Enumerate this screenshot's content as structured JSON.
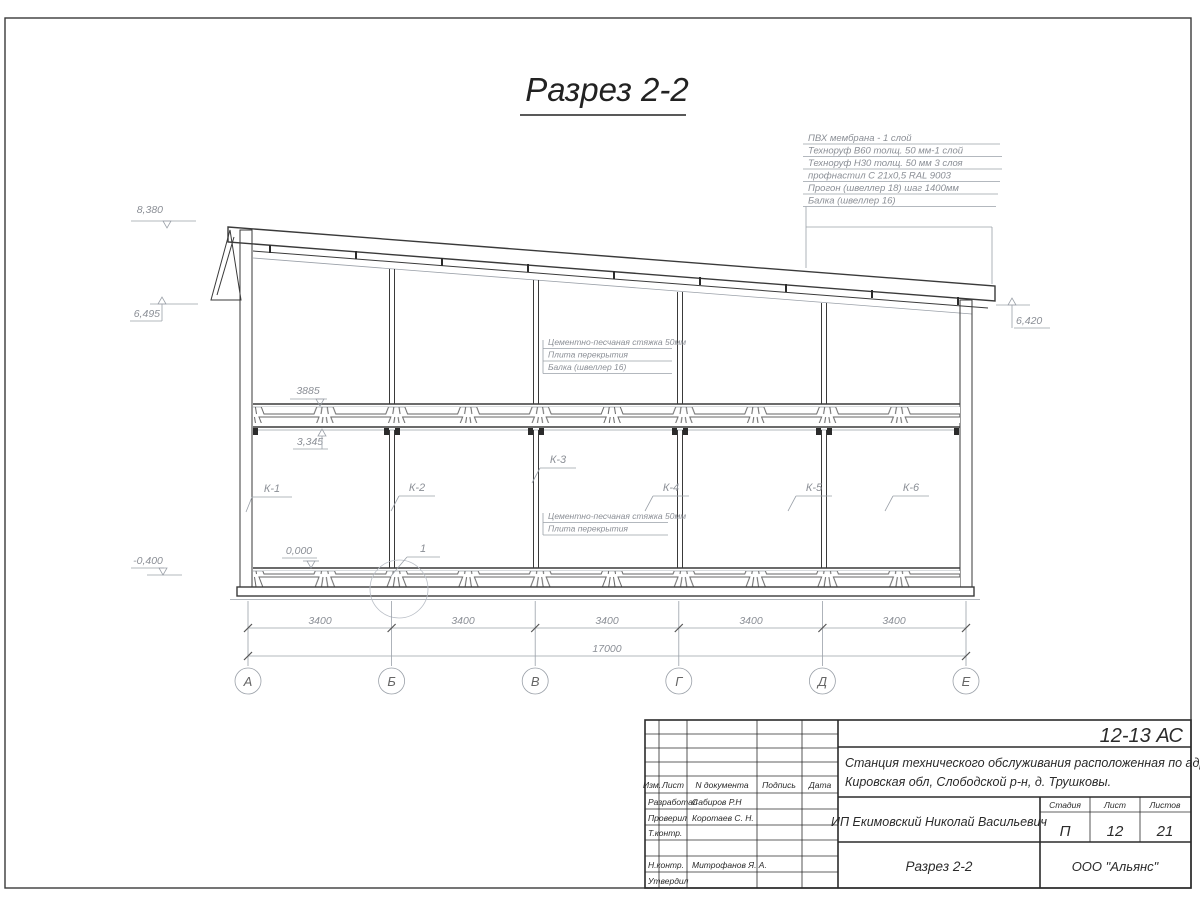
{
  "title": {
    "text": "Разрез 2-2"
  },
  "annotations": {
    "roof_layers": [
      "ПВХ мембрана - 1 слой",
      "Техноруф В60 толщ. 50 мм-1 слой",
      "Техноруф Н30 толщ. 50 мм 3 слоя",
      "профнастил С 21х0,5 RAL 9003",
      "Прогон (швеллер 18) шаг 1400мм",
      "Балка (швеллер 16)"
    ],
    "upper_floor": [
      "Цементно-песчаная стяжка 50мм",
      "Плита перекрытия",
      "Балка (швеллер 16)"
    ],
    "lower_floor": [
      "Цементно-песчаная стяжка 50мм",
      "Плита перекрытия"
    ]
  },
  "elevation_marks": {
    "top": "8,380",
    "eaves_left": "6,495",
    "eaves_right": "6,420",
    "slab_top": "3885",
    "beam_bottom": "3,345",
    "floor": "0,000",
    "ground": "-0,400"
  },
  "column_labels": [
    "К-1",
    "К-2",
    "К-3",
    "К-4",
    "К-5",
    "К-6"
  ],
  "detail_label": "1",
  "dims": {
    "bays": [
      "3400",
      "3400",
      "3400",
      "3400",
      "3400"
    ],
    "total": "17000"
  },
  "axis_labels": [
    "А",
    "Б",
    "В",
    "Г",
    "Д",
    "Е"
  ],
  "title_block": {
    "doc_number": "12-13 АС",
    "project_lines": [
      "Станция технического обслуживания расположенная по адресу",
      "Кировская обл, Слободской р-н, д. Трушковы."
    ],
    "client": "ИП Екимовский Николай Васильевич",
    "sheet_title": "Разрез 2-2",
    "company": "ООО \"Альянс\"",
    "stage_label": "Стадия",
    "sheet_label": "Лист",
    "sheets_label": "Листов",
    "stage": "П",
    "sheet": "12",
    "sheets": "21",
    "header": {
      "izm": "Изм.",
      "list": "Лист",
      "doc": "N документа",
      "sign": "Подпись",
      "date": "Дата"
    },
    "roles": [
      {
        "role": "Разработал",
        "name": "Сабиров Р.Н"
      },
      {
        "role": "Проверил",
        "name": "Коротаев С. Н."
      },
      {
        "role": "Т.контр.",
        "name": ""
      },
      {
        "role": "Н.контр.",
        "name": "Митрофанов Я. А."
      },
      {
        "role": "Утвердил",
        "name": ""
      }
    ]
  }
}
